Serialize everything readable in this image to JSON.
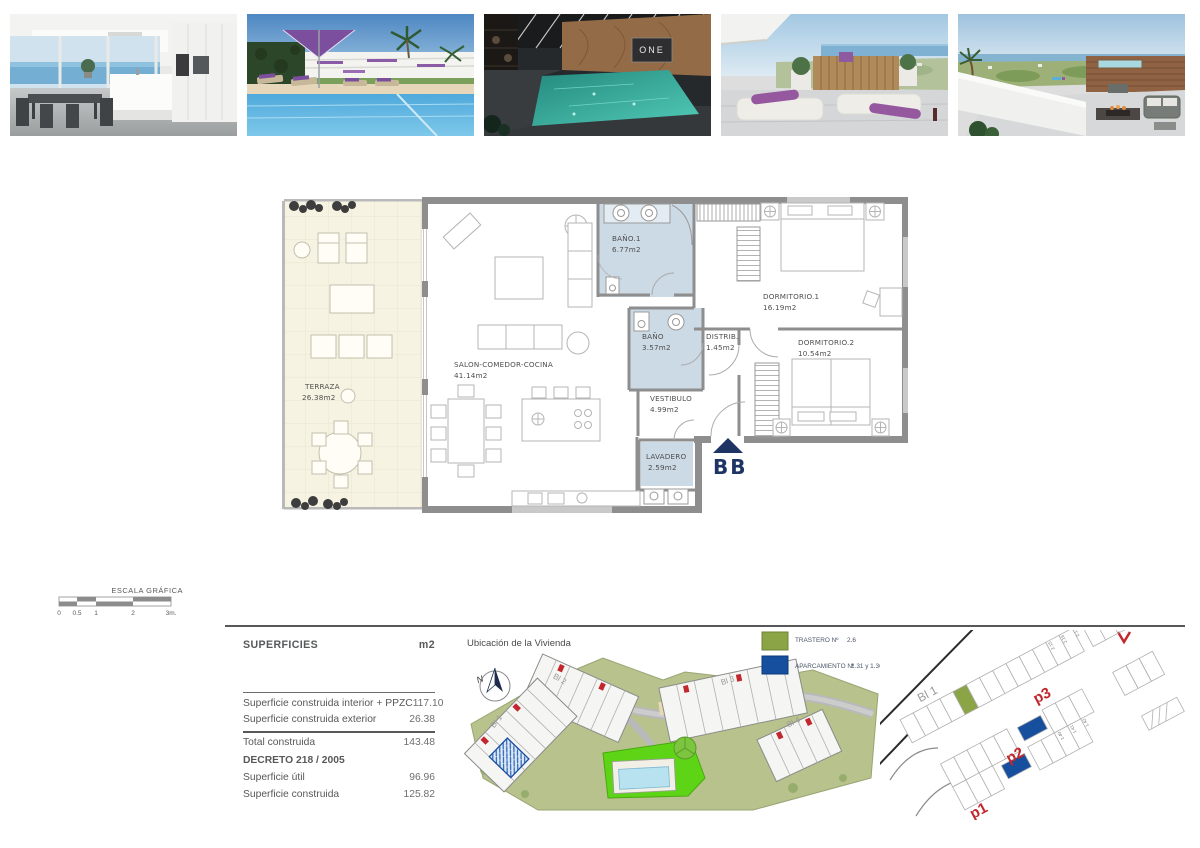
{
  "page": {
    "width": 1200,
    "height": 848
  },
  "photos": {
    "names": [
      "interior-salon-cocina",
      "piscina-exterior",
      "spa-piscina-interior",
      "terraza-solarium",
      "azotea-vistas"
    ],
    "spa_sign_text": "ONE"
  },
  "floor_plan": {
    "rooms": [
      {
        "name": "TERRAZA",
        "area": "26.38m2"
      },
      {
        "name": "SALON-COMEDOR-COCINA",
        "area": "41.14m2"
      },
      {
        "name": "BAÑO.1",
        "area": "6.77m2"
      },
      {
        "name": "BAÑO",
        "area": "3.57m2"
      },
      {
        "name": "DISTRIB.",
        "area": "1.45m2"
      },
      {
        "name": "DORMITORIO.1",
        "area": "16.19m2"
      },
      {
        "name": "DORMITORIO.2",
        "area": "10.54m2"
      },
      {
        "name": "VESTIBULO",
        "area": "4.99m2"
      },
      {
        "name": "LAVADERO",
        "area": "2.59m2"
      }
    ],
    "entrance_label": "BB",
    "colors": {
      "wet_room": "#ccdae6",
      "terrace": "#f7f3e3",
      "wall": "#8e8e8e",
      "entrance_marker": "#1d3464"
    }
  },
  "scale_bar": {
    "title": "ESCALA GRÁFICA",
    "ticks": [
      "0",
      "0.5",
      "1",
      "2",
      "3m."
    ]
  },
  "surfaces_table": {
    "title": "SUPERFICIES",
    "unit": "m2",
    "rows": [
      {
        "label": "Superficie construida interior + PPZC",
        "value": "117.10"
      },
      {
        "label": "Superficie construida exterior",
        "value": "26.38"
      },
      {
        "label": "Total construida",
        "value": "143.48"
      }
    ],
    "decree": "DECRETO 218 / 2005",
    "decree_rows": [
      {
        "label": "Superficie útil",
        "value": "96.96"
      },
      {
        "label": "Superficie construida",
        "value": "125.82"
      }
    ]
  },
  "site_plan": {
    "title": "Ubicación de la Vivienda",
    "compass": "N",
    "blocks": [
      "Bl 1",
      "Bl 2",
      "Bl 3",
      "Bl 4"
    ],
    "legend": [
      {
        "label": "TRASTERO Nº",
        "value": "2.6",
        "color": "#8ba446"
      },
      {
        "label": "APARCAMIENTO Nº",
        "value": "1.31 y 1.36",
        "color": "#164f9e"
      }
    ]
  },
  "parking_plan": {
    "block_label": "Bl 1",
    "level_labels": [
      "p1",
      "p2",
      "p3"
    ],
    "stall_numbers": [
      "2.15",
      "2.16",
      "2.17",
      "1.40",
      "1.41",
      "1.42"
    ]
  }
}
